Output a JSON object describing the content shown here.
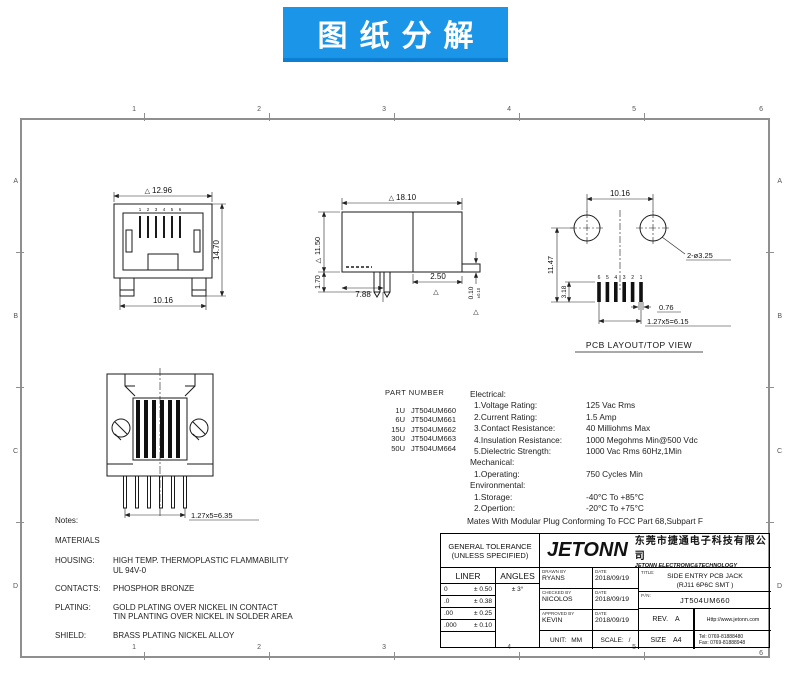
{
  "banner": {
    "text": "图纸分解"
  },
  "frame": {
    "cols": [
      "1",
      "2",
      "3",
      "4",
      "5",
      "6"
    ],
    "rows": [
      "A",
      "B",
      "C",
      "D"
    ]
  },
  "glyphs": {
    "triangle": "△"
  },
  "views": {
    "front": {
      "dim_width": "12.96",
      "dim_height": "14.70",
      "dim_feet": "10.16",
      "pins": [
        "1",
        "2",
        "3",
        "4",
        "5",
        "6"
      ]
    },
    "side": {
      "dim_width": "18.10",
      "dim_height": "11.50",
      "dim_leg": "1.70",
      "dim_leg_pos": "7.88",
      "dim_tab": "2.50",
      "dim_standoff": "0.10",
      "dim_standoff_tol": "±0.10"
    },
    "pcb": {
      "caption": "PCB LAYOUT/TOP VIEW",
      "dim_span": "10.16",
      "dim_depth": "11.47",
      "dim_pad": "3.18",
      "holes": "2-ø3.25",
      "dim_width": "0.76",
      "dim_pitch": "1.27x5=6.15",
      "pads": [
        "6",
        "5",
        "4",
        "3",
        "2",
        "1"
      ]
    },
    "bottom": {
      "dim_pitch": "1.27x5=6.35"
    }
  },
  "part_numbers": {
    "heading": "PART NUMBER",
    "items": [
      {
        "code": "1U",
        "pn": "JT504UM660"
      },
      {
        "code": "6U",
        "pn": "JT504UM661"
      },
      {
        "code": "15U",
        "pn": "JT504UM662"
      },
      {
        "code": "30U",
        "pn": "JT504UM663"
      },
      {
        "code": "50U",
        "pn": "JT504UM664"
      }
    ]
  },
  "specs": {
    "electrical_heading": "Electrical:",
    "electrical": [
      {
        "label": "1.Voltage Rating:",
        "value": "125 Vac Rms"
      },
      {
        "label": "2.Current Rating:",
        "value": "1.5 Amp"
      },
      {
        "label": "3.Contact Resistance:",
        "value": "40 Milliohms Max"
      },
      {
        "label": "4.Insulation Resistance:",
        "value": "1000 Megohms Min@500 Vdc"
      },
      {
        "label": "5.Dielectric Strength:",
        "value": "1000 Vac Rms 60Hz,1Min"
      }
    ],
    "mechanical_heading": "Mechanical:",
    "mechanical": [
      {
        "label": "1.Operating:",
        "value": "750 Cycles Min"
      }
    ],
    "environmental_heading": "Environmental:",
    "environmental": [
      {
        "label": "1.Storage:",
        "value": "-40°C To +85°C"
      },
      {
        "label": "2.Opertion:",
        "value": "-20°C To +75°C"
      }
    ],
    "mates_note": "Mates With Modular Plug Conforming To FCC Part 68,Subpart F"
  },
  "notes": {
    "heading": "Notes:",
    "materials_heading": "MATERIALS",
    "rows": [
      {
        "label": "HOUSING:",
        "value": "HIGH TEMP. THERMOPLASTIC FLAMMABILITY\nUL 94V-0"
      },
      {
        "label": "CONTACTS:",
        "value": "PHOSPHOR BRONZE"
      },
      {
        "label": "PLATING:",
        "value": "GOLD PLATING OVER NICKEL IN CONTACT\nTIN PLANTING OVER NICKEL IN SOLDER AREA"
      },
      {
        "label": "SHIELD:",
        "value": "BRASS PLATING NICKEL ALLOY"
      }
    ]
  },
  "title_block": {
    "tolerance": {
      "heading_line1": "GENERAL TOLERANCE",
      "heading_line2": "(UNLESS SPECIFIED)",
      "liner_label": "LINER",
      "angles_label": "ANGLES",
      "angle_value": "± 3°",
      "rows": [
        {
          "base": "0",
          "tol": "± 0.50"
        },
        {
          "base": ".0",
          "tol": "± 0.38"
        },
        {
          "base": ".00",
          "tol": "± 0.25"
        },
        {
          "base": ".000",
          "tol": "± 0.10"
        }
      ]
    },
    "logo_text": "JETONN",
    "company_cn": "东莞市捷通电子科技有限公司",
    "company_en": "JETONN ELECTRONIC&TECHNOLOGY",
    "signoff": [
      {
        "role": "DRAWN BY",
        "name": "RYANS",
        "date_label": "DATE",
        "date": "2018/09/19"
      },
      {
        "role": "CHECKED BY",
        "name": "NICOLOS",
        "date_label": "DATE",
        "date": "2018/09/19"
      },
      {
        "role": "APPROVED BY",
        "name": "KEVIN",
        "date_label": "DATE",
        "date": "2018/09/19"
      }
    ],
    "unit": {
      "label": "UNIT:",
      "value": "MM"
    },
    "scale": {
      "label": "SCALE:",
      "value": "/"
    },
    "title": {
      "label": "TITLE:",
      "line1": "SIDE ENTRY PCB JACK",
      "line2": "(RJ11 6P6C SMT )"
    },
    "part_no": {
      "label": "P/N:",
      "value": "JT504UM660"
    },
    "rev": {
      "label": "REV.",
      "value": "A"
    },
    "size": {
      "label": "SIZE",
      "value": "A4"
    },
    "website": "Http://www.jetonn.com",
    "tel": "Tel:  0769-81888480",
    "fax": "Fax: 0769-81888948"
  }
}
